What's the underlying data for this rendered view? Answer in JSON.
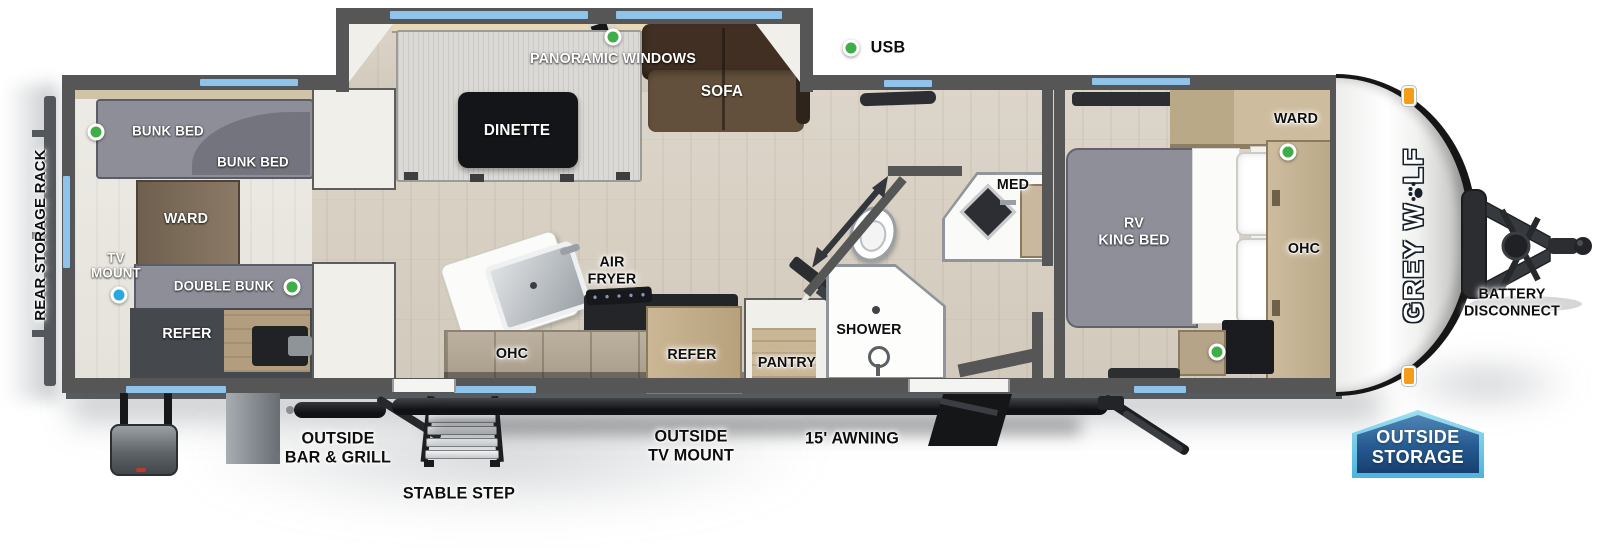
{
  "legend": {
    "usb": "USB"
  },
  "plan": {
    "bunk_room": {
      "bunk_bed_upper": "BUNK BED",
      "bunk_bed_lower": "BUNK BED",
      "ward": "WARD",
      "tv_mount_l1": "TV",
      "tv_mount_l2": "MOUNT",
      "double_bunk": "DOUBLE BUNK",
      "refer": "REFER"
    },
    "living": {
      "panoramic_windows": "PANORAMIC WINDOWS",
      "dinette": "DINETTE",
      "sofa": "SOFA"
    },
    "kitchen": {
      "air_fryer_l1": "AIR",
      "air_fryer_l2": "FRYER",
      "ohc": "OHC",
      "refer": "REFER",
      "pantry": "PANTRY"
    },
    "bathroom": {
      "shower": "SHOWER",
      "med": "MED"
    },
    "bedroom": {
      "bed_l1": "RV",
      "bed_l2": "KING BED",
      "ward": "WARD",
      "ohc": "OHC"
    }
  },
  "exterior": {
    "rear_storage_rack": "REAR STORAGE RACK",
    "battery_l1": "BATTERY",
    "battery_l2": "DISCONNECT",
    "outside_bar_grill_l1": "OUTSIDE",
    "outside_bar_grill_l2": "BAR & GRILL",
    "stable_step": "STABLE STEP",
    "outside_tv_mount_l1": "OUTSIDE",
    "outside_tv_mount_l2": "TV MOUNT",
    "awning": "15' AWNING",
    "outside_storage_l1": "OUTSIDE",
    "outside_storage_l2": "STORAGE",
    "brand": "GREY WOLF",
    "brand_prefix": "GREY W",
    "brand_suffix": "LF"
  },
  "colors": {
    "usb_dot": "#3fae49",
    "tv_jack_dot": "#29a7e0",
    "window_blue": "#8fc3ea",
    "wall_gray": "#565656",
    "badge_fill": "#1f5187",
    "badge_border": "#63c3e6",
    "marker_light_orange": "#f59d18"
  }
}
